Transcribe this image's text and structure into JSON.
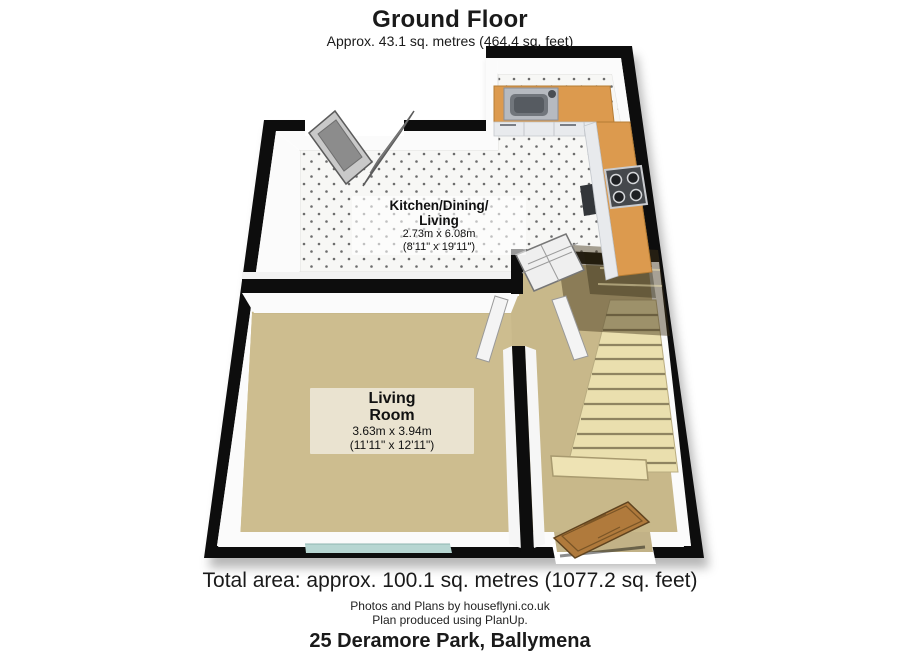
{
  "header": {
    "title": "Ground Floor",
    "subtitle": "Approx. 43.1 sq. metres (464.4 sq. feet)"
  },
  "rooms": {
    "kitchen": {
      "name_line1": "Kitchen/Dining/",
      "name_line2": "Living",
      "dims_metric": "2.73m x 6.08m",
      "dims_imperial": "(8'11\" x 19'11\")"
    },
    "living": {
      "name_line1": "Living",
      "name_line2": "Room",
      "dims_metric": "3.63m x 3.94m",
      "dims_imperial": "(11'11\" x 12'11\")"
    }
  },
  "footer": {
    "total_area": "Total area: approx. 100.1 sq. metres (1077.2 sq. feet)",
    "credit_line1": "Photos and Plans by houseflyni.co.uk",
    "credit_line2": "Plan produced using PlanUp.",
    "address": "25 Deramore Park, Ballymena"
  },
  "colors": {
    "wall": "#0d0d0d",
    "carpet": "#cbbb8d",
    "kitchen_floor": "#f7f7f5",
    "counter_wood": "#dc9a4e",
    "stairs": "#ead FILLER",
    "stair_tread": "#eadfae",
    "front_door_wood": "#b07a3c",
    "window_glass": "#b7d6d2"
  }
}
